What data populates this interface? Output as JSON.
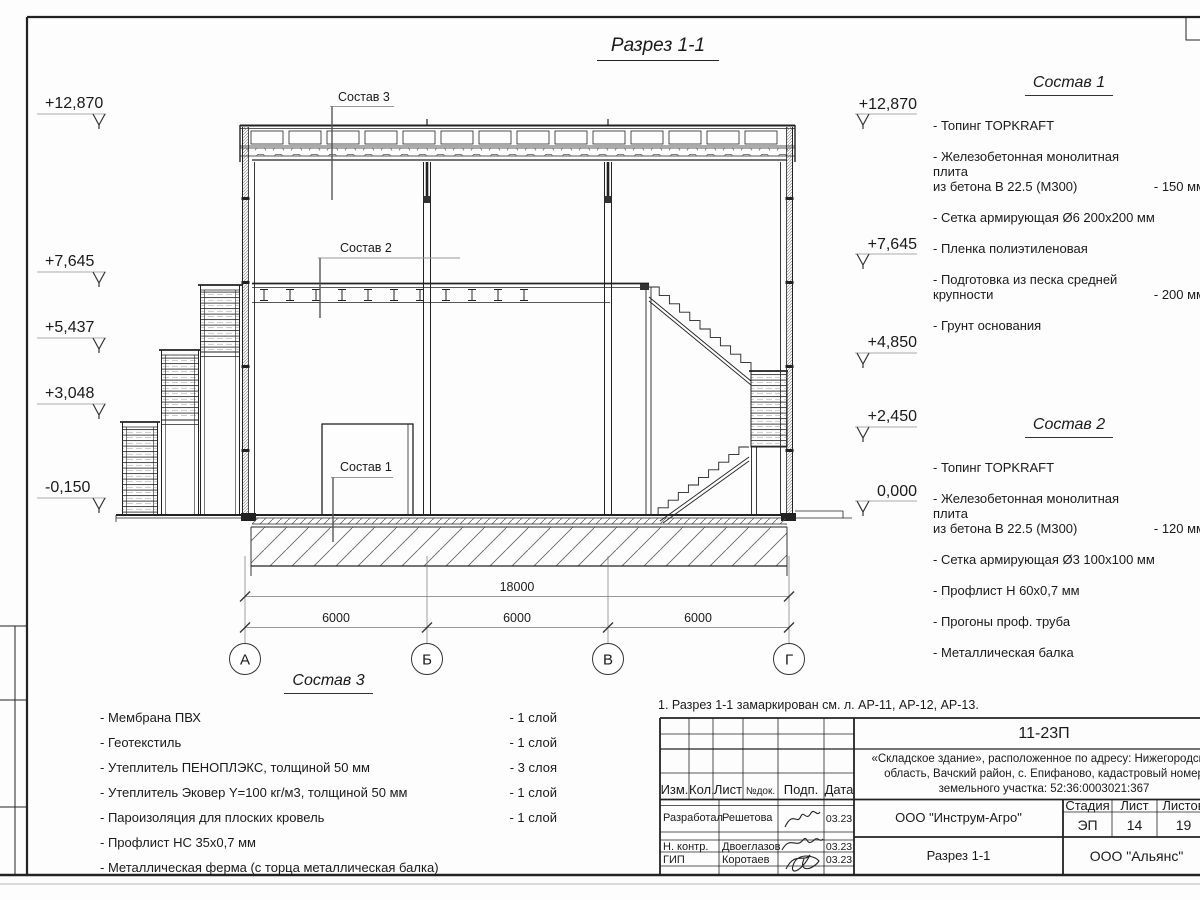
{
  "sheet": {
    "title": "Разрез 1-1",
    "note": "1. Разрез 1-1 замаркирован см. л. АР-11, АР-12, АР-13."
  },
  "elevations": {
    "left": [
      "+12,870",
      "+7,645",
      "+5,437",
      "+3,048",
      "-0,150"
    ],
    "right": [
      "+12,870",
      "+7,645",
      "+4,850",
      "+2,450",
      "0,000"
    ]
  },
  "dimensions": {
    "overall": "18000",
    "bays": [
      "6000",
      "6000",
      "6000"
    ]
  },
  "axes": [
    "А",
    "Б",
    "В",
    "Г"
  ],
  "leaders": {
    "l1": "Состав 1",
    "l2": "Состав 2",
    "l3": "Состав 3"
  },
  "sostav1": {
    "title": "Состав 1",
    "items": [
      {
        "text": "- Топинг TOPKRAFT",
        "value": ""
      },
      {
        "text": "- Железобетонная  монолитная плита\nиз бетона  В 22.5 (М300)",
        "value": "- 150 мм"
      },
      {
        "text": "- Сетка армирующая Ø6 200x200 мм",
        "value": ""
      },
      {
        "text": "- Пленка полиэтиленовая",
        "value": ""
      },
      {
        "text": "- Подготовка из песка средней\nкрупности",
        "value": "- 200 мм"
      },
      {
        "text": "- Грунт основания",
        "value": ""
      }
    ]
  },
  "sostav2": {
    "title": "Состав 2",
    "items": [
      {
        "text": "- Топинг TOPKRAFT",
        "value": ""
      },
      {
        "text": "- Железобетонная  монолитная плита\nиз бетона  В 22.5 (М300)",
        "value": "- 120 мм"
      },
      {
        "text": "- Сетка армирующая Ø3 100x100 мм",
        "value": ""
      },
      {
        "text": "- Профлист Н 60x0,7 мм",
        "value": ""
      },
      {
        "text": "- Прогоны проф. труба",
        "value": ""
      },
      {
        "text": "- Металлическая балка",
        "value": ""
      }
    ]
  },
  "sostav3": {
    "title": "Состав 3",
    "items": [
      {
        "text": "- Мембрана ПВХ",
        "value": "- 1 слой"
      },
      {
        "text": "- Геотекстиль",
        "value": "- 1 слой"
      },
      {
        "text": "- Утеплитель ПЕНОПЛЭКС, толщиной 50 мм",
        "value": "- 3 слоя"
      },
      {
        "text": "- Утеплитель Эковер Y=100 кг/м3, толщиной 50 мм",
        "value": "- 1 слой"
      },
      {
        "text": "- Пароизоляция для плоских кровель",
        "value": "- 1 слой"
      },
      {
        "text": "- Профлист НС 35x0,7 мм",
        "value": ""
      },
      {
        "text": "- Металлическая ферма (с торца металлическая балка)",
        "value": ""
      }
    ]
  },
  "titleblock": {
    "doc_number": "11-23П",
    "project": "«Складское здание», расположенное по адресу:\nНижегородская область, Вачский район, с. Епифаново,\nкадастровый номер земельного участка: 52:36:0003021:367",
    "cols": {
      "izm": "Изм.",
      "kol": "Кол.",
      "list": "Лист",
      "ndok": "№док.",
      "podp": "Подп.",
      "data": "Дата"
    },
    "rows": [
      {
        "role": "Разработал",
        "name": "Решетова",
        "date": "03.23"
      },
      {
        "role": "Н. контр.",
        "name": "Двоеглазов",
        "date": "03.23"
      },
      {
        "role": "ГИП",
        "name": "Коротаев",
        "date": "03.23"
      }
    ],
    "org": "ООО \"Инструм-Агро\"",
    "stage_label": "Стадия",
    "sheet_label": "Лист",
    "sheets_label": "Листов",
    "stage": "ЭП",
    "sheet_no": "14",
    "sheets_total": "19",
    "drawing_name": "Разрез 1-1",
    "company": "ООО \"Альянс\""
  }
}
